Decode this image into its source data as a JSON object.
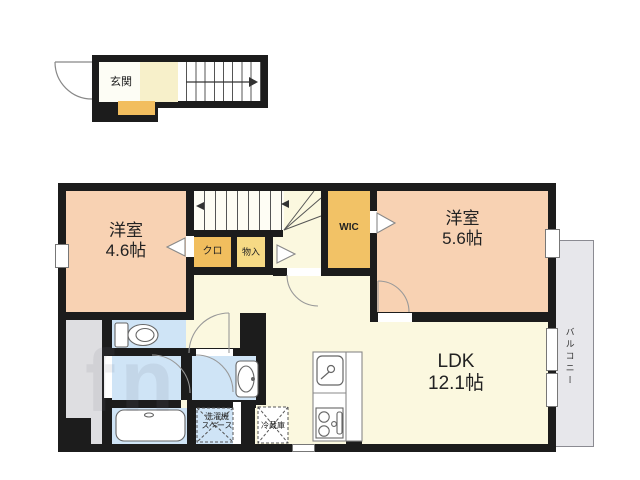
{
  "entrance": {
    "label": "玄関"
  },
  "rooms": {
    "bedroom1": {
      "name": "洋室",
      "size": "4.6帖"
    },
    "bedroom2": {
      "name": "洋室",
      "size": "5.6帖"
    },
    "ldk": {
      "name": "LDK",
      "size": "12.1帖"
    },
    "wic": {
      "label": "WIC"
    },
    "closet": {
      "label": "クロ"
    },
    "storage": {
      "label": "物入"
    },
    "balcony": {
      "label": "バルコニー"
    },
    "laundry_space": {
      "line1": "洗濯機",
      "line2": "スペース"
    },
    "refrigerator": {
      "label": "冷蔵庫"
    }
  },
  "fixtures": [
    "toilet",
    "bathtub",
    "washbasin",
    "kitchen-sink",
    "gas-stove",
    "staircase",
    "entrance-door"
  ],
  "colors": {
    "wall": "#1c1c1c",
    "floor_cream": "#fbf8df",
    "room_peach": "#f8d2b3",
    "closet_orange": "#f1be5e",
    "storage_yellow": "#f6da85",
    "wet_area_blue": "#cfe4f6",
    "outdoor_gray": "#dedee1",
    "balcony_gray": "#e7e7eb",
    "entry_cream": "#f7f0ca"
  },
  "watermark": {
    "text": "fn"
  }
}
